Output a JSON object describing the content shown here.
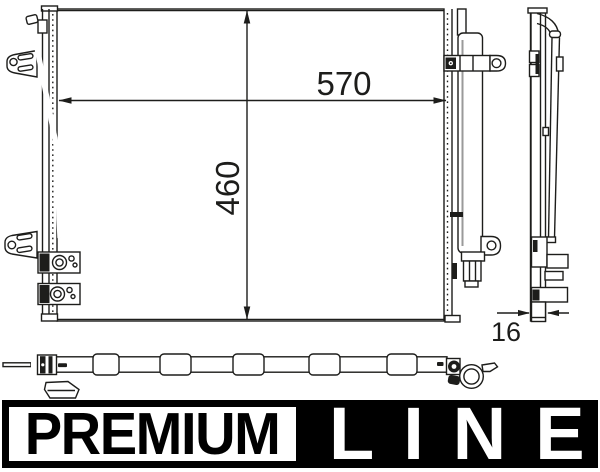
{
  "drawing": {
    "dimensions": {
      "width_label": "570",
      "height_label": "460",
      "depth_label": "16"
    }
  },
  "banner": {
    "premium_label": "PREMIUM",
    "line_label": "LINE"
  },
  "colors": {
    "line": "#1d1d1b",
    "banner_black": "#000000",
    "banner_text_white": "#ffffff",
    "background": "#ffffff"
  }
}
